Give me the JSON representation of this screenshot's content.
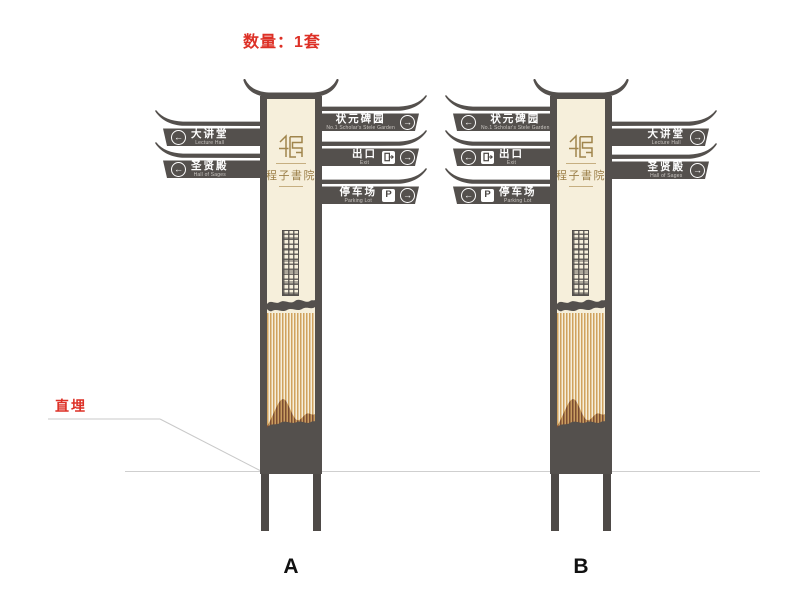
{
  "annotations": {
    "quantity": "数量：1套",
    "burial": "直埋"
  },
  "poles": {
    "a": {
      "label": "A"
    },
    "b": {
      "label": "B"
    }
  },
  "logo": {
    "title": "程子書院"
  },
  "icons": {
    "arrow_left": "←",
    "arrow_right": "→",
    "parking_letter": "P"
  },
  "signs": {
    "lecture_hall": {
      "cn": "大讲堂",
      "en": "Lecture Hall"
    },
    "hall_of_sages": {
      "cn": "圣贤殿",
      "en": "Hall of Sages"
    },
    "stele_garden": {
      "cn": "状元碑园",
      "en": "No.1 Scholar's Stele Garden"
    },
    "exit": {
      "cn": "出口",
      "en": "Exit"
    },
    "parking": {
      "cn": "停车场",
      "en": "Parking Lot"
    }
  },
  "colors": {
    "dark_gray": "#54504D",
    "cream": "#F6EFDB",
    "stripe_gold": "#D0A25E",
    "mountain_brown": "#7C4C31",
    "logo_gold": "#A0854C",
    "accent_red": "#DD3026",
    "guide_line": "#C9C9C9"
  }
}
